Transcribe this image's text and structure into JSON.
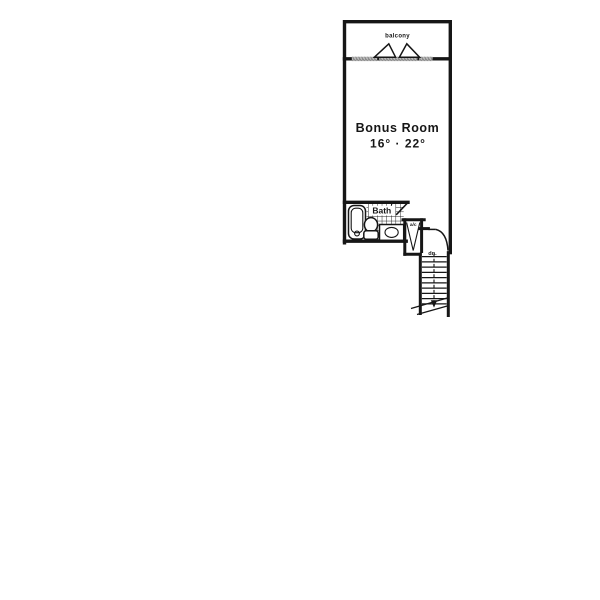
{
  "palette": {
    "ink": "#161616",
    "paper": "#ffffff",
    "sill_gray": "#9a9a9a"
  },
  "plan": {
    "balcony": {
      "label": "balcony"
    },
    "bonus_room": {
      "label": "Bonus Room",
      "dimensions": "16° · 22°"
    },
    "bathroom": {
      "label": "Bath"
    },
    "utility_closet": {
      "label": "a/c"
    },
    "stairs": {
      "direction_label": "dn."
    }
  }
}
